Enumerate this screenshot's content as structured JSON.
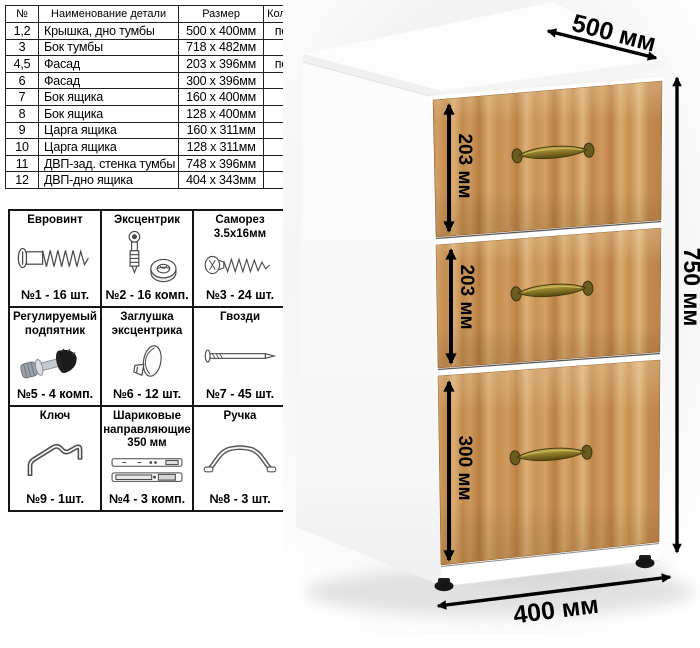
{
  "parts_table": {
    "headers": [
      "№",
      "Наименование детали",
      "Размер",
      "Количество"
    ],
    "rows": [
      [
        "1,2",
        "Крышка, дно тумбы",
        "500 x 400мм",
        "по 1 шт."
      ],
      [
        "3",
        "Бок тумбы",
        "718 x 482мм",
        "2 шт."
      ],
      [
        "4,5",
        "Фасад",
        "203 x 396мм",
        "по 1 шт."
      ],
      [
        "6",
        "Фасад",
        "300 x 396мм",
        "1 шт."
      ],
      [
        "7",
        "Бок ящика",
        "160 x 400мм",
        "2 шт."
      ],
      [
        "8",
        "Бок ящика",
        "128 x 400мм",
        "4 шт."
      ],
      [
        "9",
        "Царга ящика",
        "160 x 311мм",
        "1 шт."
      ],
      [
        "10",
        "Царга ящика",
        "128 x 311мм",
        "2 шт."
      ],
      [
        "11",
        "ДВП-зад. стенка тумбы",
        "748 x 396мм",
        "1 шт."
      ],
      [
        "12",
        "ДВП-дно ящика",
        "404 x 343мм",
        "3 шт."
      ]
    ]
  },
  "hardware": {
    "items": [
      {
        "title": "Евровинт",
        "icon": "euro-screw-icon",
        "count": "№1 - 16 шт."
      },
      {
        "title": "Эксцентрик",
        "icon": "eccentric-cam-icon",
        "count": "№2 - 16 комп."
      },
      {
        "title": "Саморез 3.5х16мм",
        "icon": "self-tapping-screw-icon",
        "count": "№3 - 24 шт."
      },
      {
        "title": "Регулируемый подпятник",
        "icon": "adjustable-foot-icon",
        "count": "№5 - 4 комп."
      },
      {
        "title": "Заглушка эксцентрика",
        "icon": "cam-cover-icon",
        "count": "№6 - 12 шт."
      },
      {
        "title": "Гвозди",
        "icon": "nail-icon",
        "count": "№7 - 45 шт."
      },
      {
        "title": "Ключ",
        "icon": "hex-key-icon",
        "count": "№9 - 1шт."
      },
      {
        "title": "Шариковые направляющие 350 мм",
        "icon": "drawer-slides-icon",
        "count": "№4 - 3 комп."
      },
      {
        "title": "Ручка",
        "icon": "handle-icon",
        "count": "№8 - 3 шт."
      }
    ]
  },
  "cabinet": {
    "dimensions": {
      "depth": "500 мм",
      "height": "750 мм",
      "width": "400 мм",
      "drawer1": "203 мм",
      "drawer2": "203 мм",
      "drawer3": "300 мм"
    },
    "palette": {
      "wood": "#c9945a",
      "wood_dark": "#b67c40",
      "wood_light": "#dfb37b",
      "handle_brass": "#8a7828",
      "foot_black": "#161616",
      "carcass": "#fdfdfd",
      "backdrop": "#ededed",
      "line_black": "#000000"
    }
  }
}
